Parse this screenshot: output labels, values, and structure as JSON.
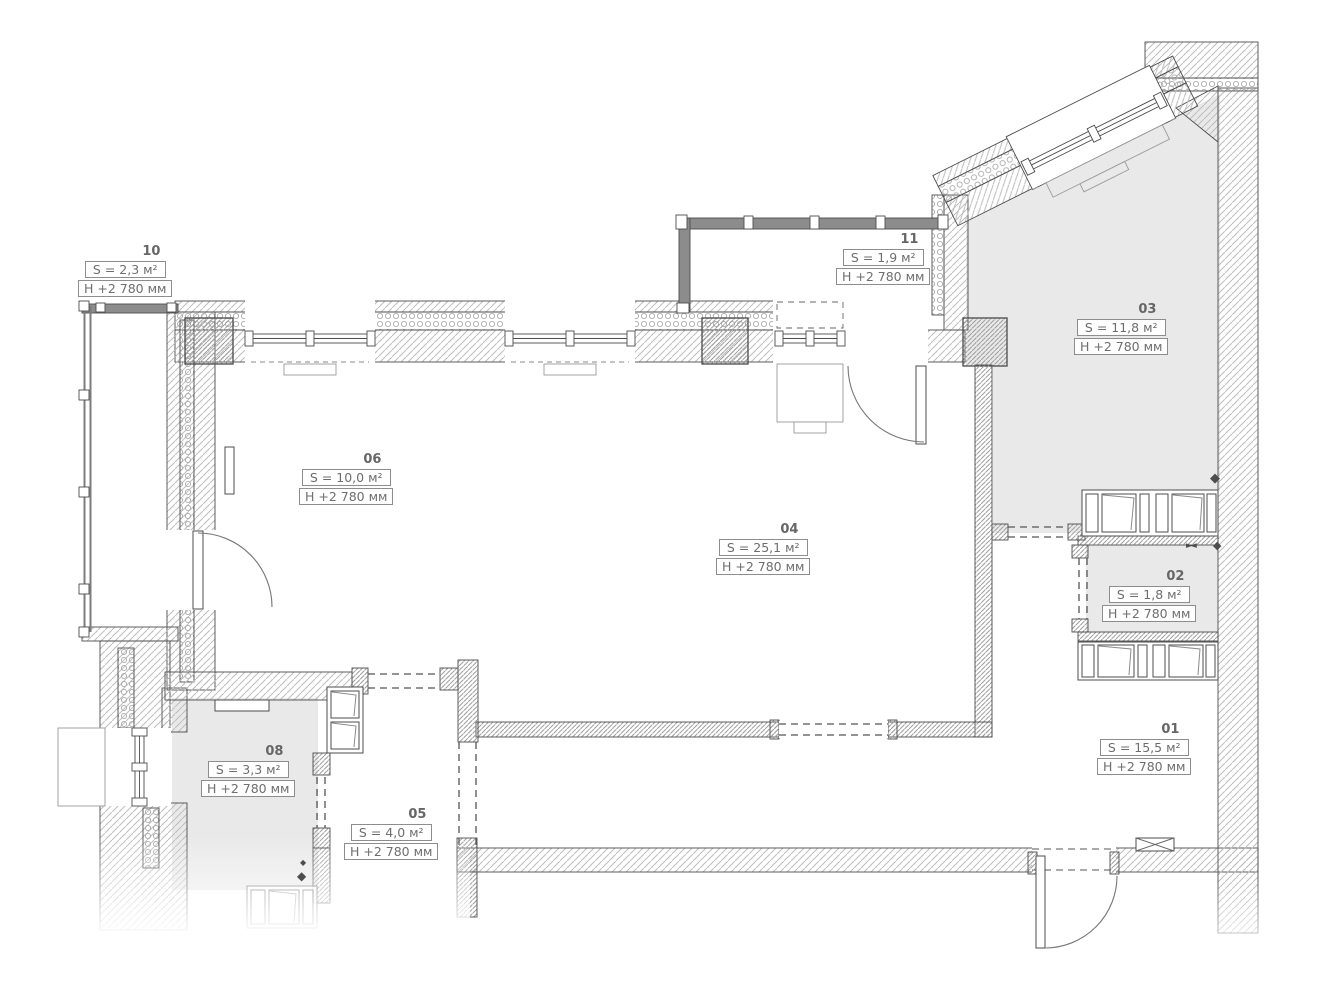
{
  "rooms": [
    {
      "number": "10",
      "area": "S = 2,3 м²",
      "height": "H +2 780 мм"
    },
    {
      "number": "11",
      "area": "S = 1,9 м²",
      "height": "H +2 780 мм"
    },
    {
      "number": "03",
      "area": "S = 11,8 м²",
      "height": "H +2 780 мм"
    },
    {
      "number": "06",
      "area": "S = 10,0 м²",
      "height": "H +2 780 мм"
    },
    {
      "number": "04",
      "area": "S = 25,1 м²",
      "height": "H +2 780 мм"
    },
    {
      "number": "02",
      "area": "S = 1,8 м²",
      "height": "H +2 780 мм"
    },
    {
      "number": "01",
      "area": "S = 15,5 м²",
      "height": "H +2 780 мм"
    },
    {
      "number": "08",
      "area": "S = 3,3 м²",
      "height": "H +2 780 мм"
    },
    {
      "number": "05",
      "area": "S = 4,0 м²",
      "height": "H +2 780 мм"
    }
  ],
  "icons": {
    "vent": "◆",
    "valve": "►◄"
  },
  "colors": {
    "room_fill": "#e9e9e9",
    "wall_line": "#4d4d4d",
    "hatch_line": "#bdbdbd",
    "glazing_bar": "#8c8c8c",
    "label_text": "#6e6e6e"
  }
}
